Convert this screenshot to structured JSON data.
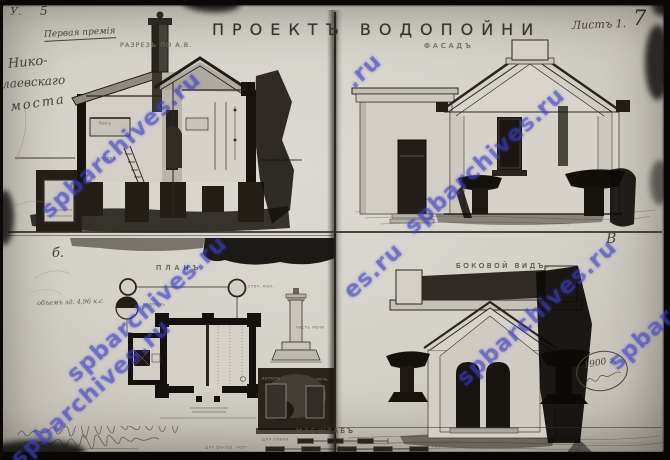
{
  "photo": {
    "watermark_text": "spbarchives.ru",
    "watermark_partial_top": ".ru",
    "watermark_partial_mid": "es.ru",
    "watermark_color": "#3e3ec4"
  },
  "header": {
    "title": "ПРОЕКТЪ ВОДОПОЙНИ",
    "sheet_label": "Листъ 1.",
    "sheet_number_handwritten": "7",
    "inventory_mark": "У.",
    "inventory_number": "5",
    "award_note": "Первая премія",
    "margin_note_lines": [
      "Нико-",
      "лаевскаго",
      "моста"
    ]
  },
  "views": {
    "section": {
      "label": "РАЗРЕЗЪ ПО А.В.",
      "tank_label": "бакъ",
      "room_label": "кладов."
    },
    "facade": {
      "label": "ФАСАДЪ",
      "corner_mark": "В"
    },
    "plan": {
      "label": "ПЛАНЪ",
      "corner_mark": "б.",
      "pencil_note": "объемъ зд. 4,96 к.с.",
      "drain_well_label": "сточ. кол.",
      "reservoir_label": "водоемъ",
      "post_detail_label": "часть печи",
      "furnace_label_left": "котелъ",
      "furnace_label_right": "печь"
    },
    "side": {
      "label": "БОКОВОЙ ВИДЪ.",
      "year_stamp": "1900 г.",
      "year_stamp_note": "handwritten word below year (illegible)"
    }
  },
  "footer": {
    "scale_title": "МАСШТАБЪ",
    "scale_plan_caption": "для плана",
    "scale_facade_caption": "для фасад. черт.",
    "scale_unit": "саж.",
    "signature_note": "two lines of cursive handwriting (illegible)"
  }
}
